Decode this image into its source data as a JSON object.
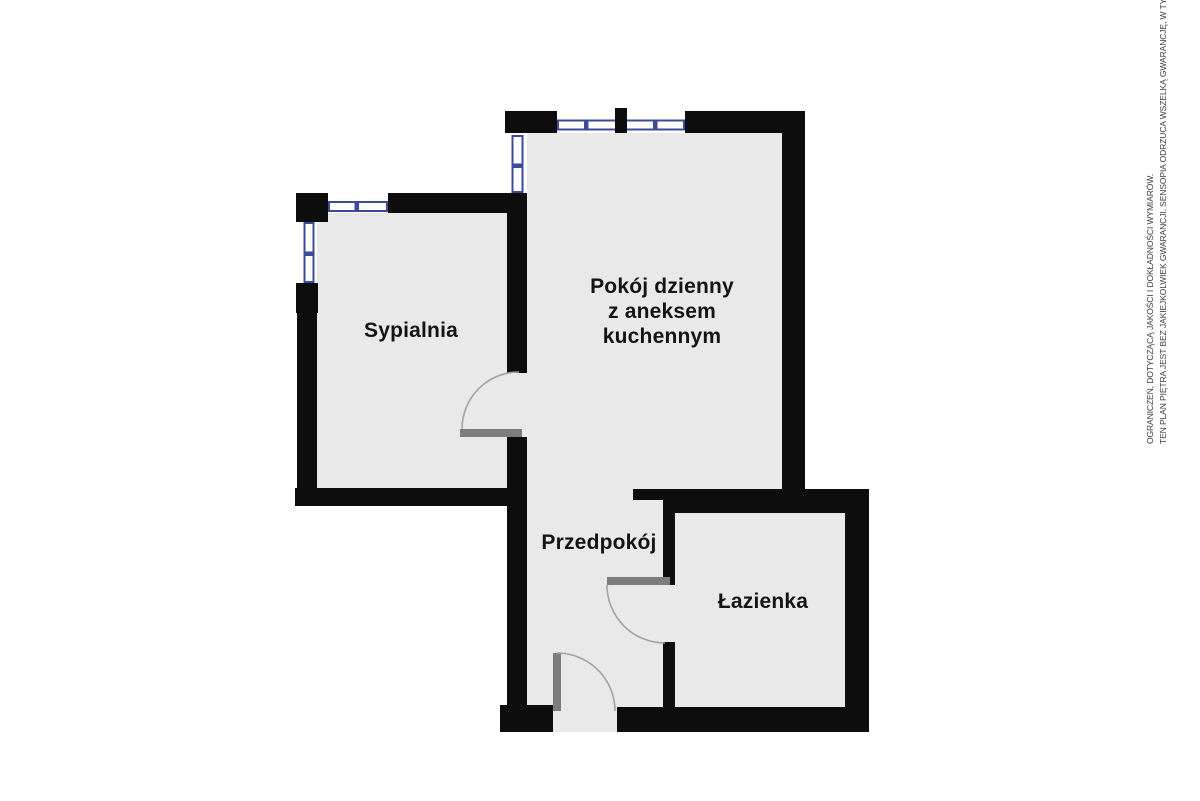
{
  "canvas": {
    "width": 1200,
    "height": 801,
    "background": "#ffffff"
  },
  "floorplan": {
    "colors": {
      "wall": "#0d0d0d",
      "floor": "#e9e9e9",
      "window_frame": "#3c4a99",
      "door_leaf": "#7d7d7d",
      "door_arc": "#a3a3a3",
      "label_text": "#141414"
    },
    "rooms": [
      {
        "id": "sypialnia",
        "label": "Sypialnia"
      },
      {
        "id": "pokoj-dzienny",
        "label": "Pokój dzienny z aneksem kuchennym",
        "label_lines": [
          "Pokój dzienny",
          "z aneksem",
          "kuchennym"
        ]
      },
      {
        "id": "przedpokoj",
        "label": "Przedpokój"
      },
      {
        "id": "lazienka",
        "label": "Łazienka"
      }
    ]
  },
  "disclaimer": {
    "line1": "TEN PLAN PIĘTRA JEST BEZ JAKIEJKOLWIEK GWARANCJI. SENSOPIA ODRZUCA WSZELKĄ GWARANCJĘ, W TYM BEZ",
    "line2": "OGRANICZEŃ, DOTYCZĄCĄ JAKOŚCI I DOKŁADNOŚCI WYMIARÓW.",
    "color": "#3d3d3d"
  }
}
